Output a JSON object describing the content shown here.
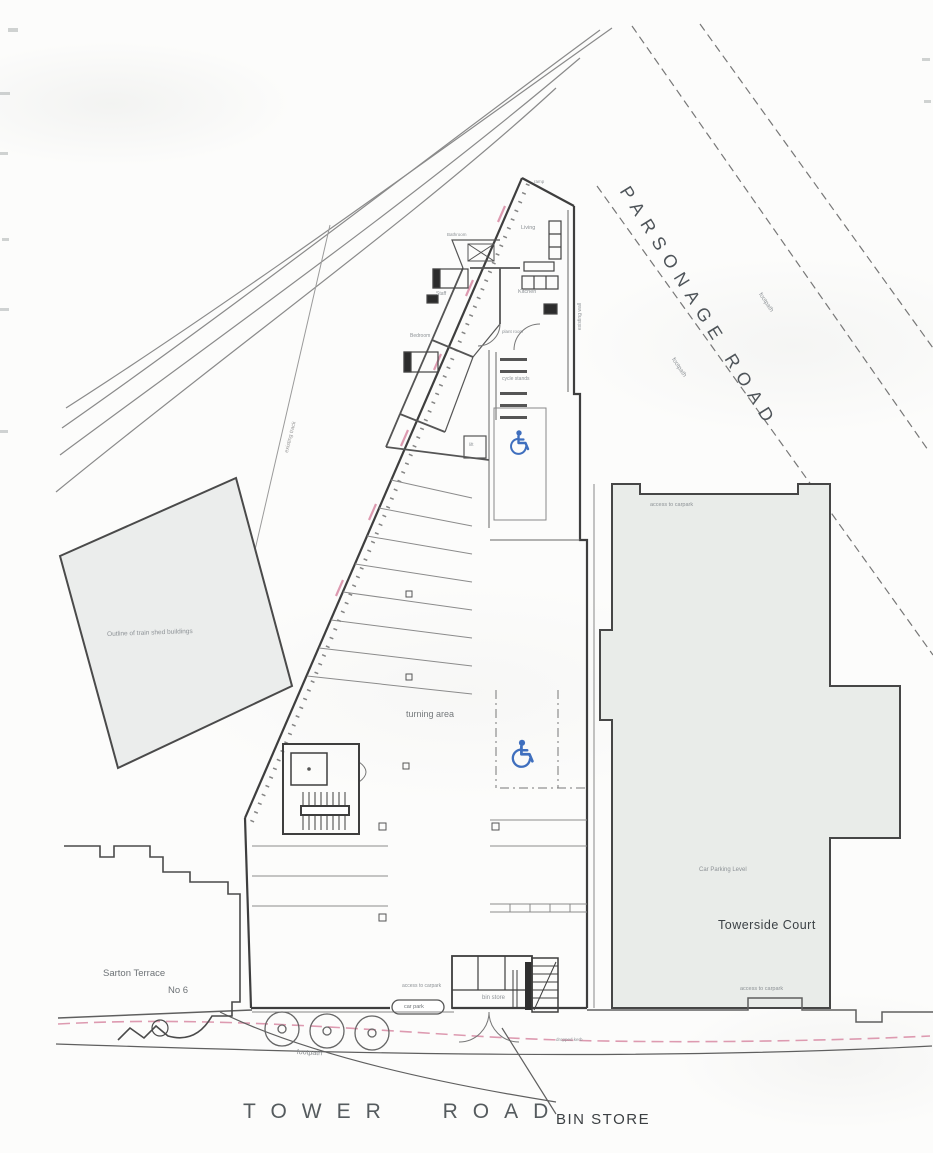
{
  "roads": {
    "parsonage_road": "PARSONAGE ROAD",
    "tower_road": "TOWER ROAD"
  },
  "callouts": {
    "bin_store": "BIN STORE"
  },
  "towerside_court": {
    "name": "Towerside Court",
    "car_parking_level": "Car Parking Level",
    "access_top": "access to carpark",
    "access_bottom": "access to carpark"
  },
  "sarton_terrace": {
    "name": "Sarton Terrace",
    "number": "No 6"
  },
  "train_shed": {
    "label": "Outline of train shed buildings"
  },
  "site": {
    "turning_area": "turning area",
    "cycle_stands": "cycle stands",
    "bin_store_room": "bin store",
    "car_park": "car park",
    "access_entrance": "access to carpark",
    "dropped_kerb": "dropped kerb",
    "footpath": "footpath"
  },
  "rooms": {
    "living": "Living",
    "kitchen": "Kitchen",
    "staff": "Staff",
    "bedroom": "Bedroom",
    "bathroom": "Bathroom",
    "plant_room": "plant room",
    "lift": "lift",
    "ramp": "ramp"
  },
  "annotations": {
    "footpath_road_upper": "footpath",
    "footpath_road_lower": "footpath",
    "existing_track": "existing track",
    "existing_wall": "existing wall"
  },
  "icons": {
    "disabled_parking": "wheelchair-icon"
  },
  "colors": {
    "line": "#4a4a4a",
    "building_fill": "#e9ece9",
    "shed_fill": "#ebedec",
    "boundary_pink": "#dd9ab0",
    "disabled_blue": "#3f6fbe"
  }
}
